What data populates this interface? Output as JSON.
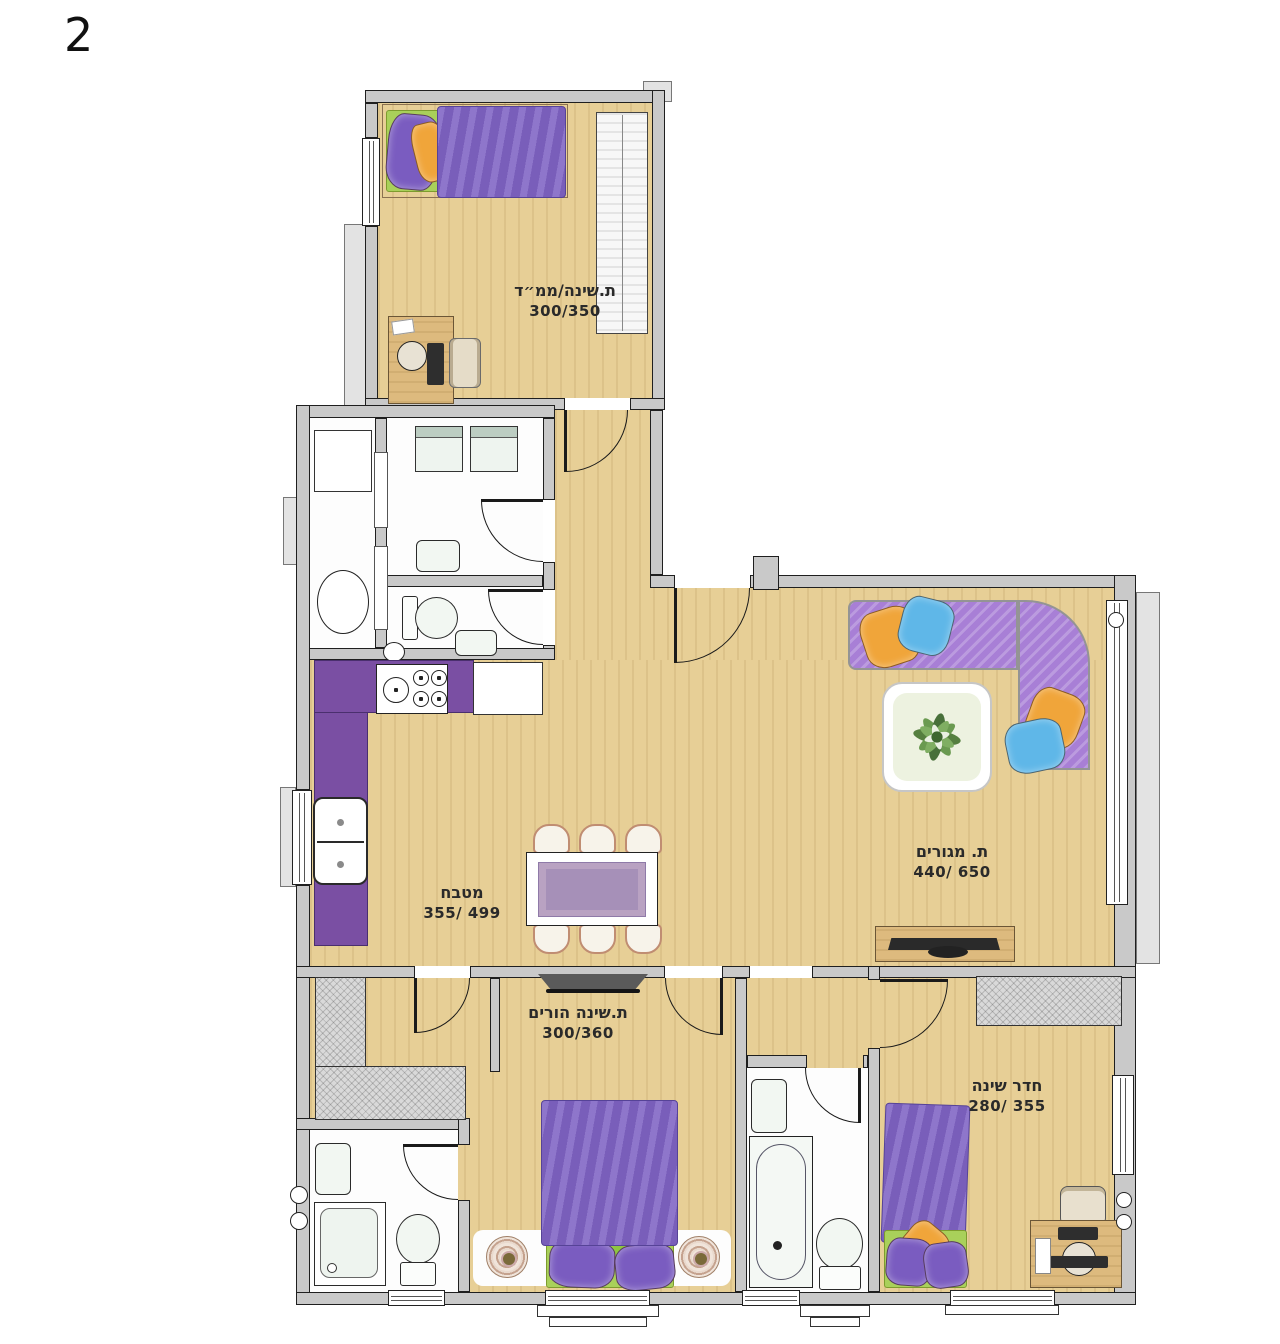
{
  "page_number": "2",
  "rooms": {
    "saferoom": {
      "name": "ת.שינה/ממ״ד",
      "dims": "300/350"
    },
    "kitchen": {
      "name": "מטבח",
      "dims": "355/ 499"
    },
    "living": {
      "name": "ת. מגורים",
      "dims": "440/ 650"
    },
    "parents": {
      "name": "ת.שינה הורים",
      "dims": "300/360"
    },
    "bedroom": {
      "name": "חדר שינה",
      "dims": "280/ 355"
    }
  },
  "colors": {
    "wood": "#e7cf96",
    "wall": "#c9c9c9",
    "wall_line": "#1f1f1f",
    "counter_purple": "#7a4fa3",
    "sofa_purple": "#a87fd6",
    "blanket_purple": "#7f63c4",
    "pillow_orange": "#f0a53a",
    "pillow_blue": "#5fb7e8",
    "mat_green": "#a9d05a",
    "fixture_white": "#f2f7f2",
    "closet_gray": "#d9d9d9",
    "label_ink": "#2a2a2a"
  }
}
